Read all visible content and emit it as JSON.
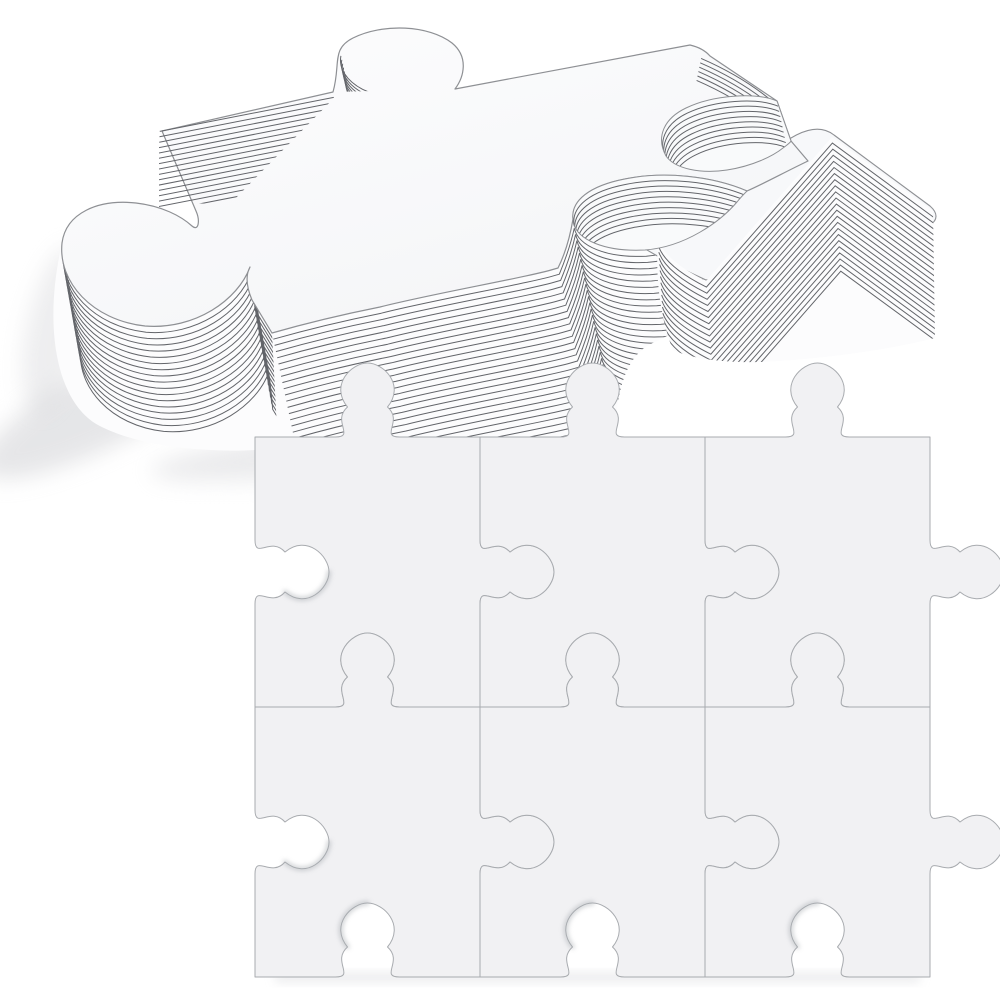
{
  "scene": {
    "description": "Stack of blank white jigsaw puzzle pieces above an assembled blank 2 by 3 puzzle grid",
    "background_color": "#ffffff"
  },
  "stack": {
    "top_face_color": "#fdfdfe",
    "face_shade_color": "#f4f5f7",
    "second_face_color": "#f7f8fa",
    "band_fill_color": "#fcfcfd",
    "bowl_fill_color": "#f9fafb",
    "layer_line_color": "#63656a",
    "outline_color": "#8e9094",
    "shadow_color": "#cdced2",
    "layer_lines": {
      "front_band": 26,
      "right_band": 22,
      "left_knob_cylinder": 17,
      "left_edge": 16,
      "right_bowl": 9,
      "bottom_bowl": 9,
      "top_knob": 7,
      "corner_edge": 6
    }
  },
  "grid": {
    "rows": 2,
    "cols": 3,
    "piece_fill": "#f1f1f3",
    "seam_color": "#a8abaf",
    "hole_shadow_color": "#a9adb2",
    "bottom_shadow_color": "#d9dadd"
  }
}
